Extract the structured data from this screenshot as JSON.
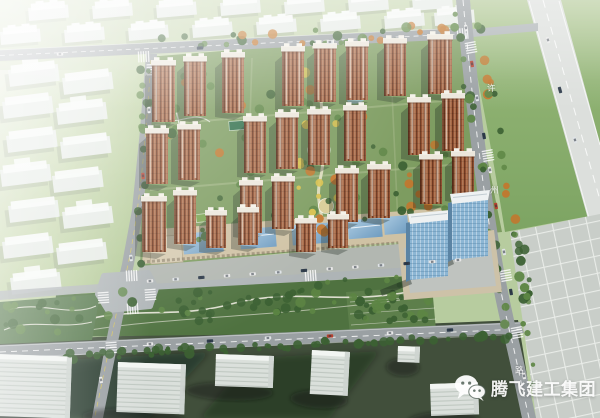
{
  "image": {
    "kind": "aerial-architectural-rendering",
    "description": "Bird's-eye master-plan rendering of a residential community with red-brown high-rise towers, central landscaped axis, south commercial strip with blue glass roofs, two blue office towers, surrounded by roads, faded context buildings and a tiled plaza"
  },
  "watermark": {
    "icon": "wechat-icon",
    "brand_text": "腾飞建工集团"
  },
  "road_labels": {
    "right_road_chars": [
      "许",
      "州",
      "路"
    ]
  },
  "palette": {
    "grass_base": "#b7cc9f",
    "grass_left": "#c8d8b0",
    "grass_right": "#8fb272",
    "site_green": "#7d9c60",
    "park_dark": "#4f7240",
    "ground_dark": "#414f3b",
    "road": "#9aa0a3",
    "road_light": "#aeb4b6",
    "road_wide": "#dcdfdc",
    "plaza": "#c9cec9",
    "ghost": "#e9edea",
    "ghost_top": "#f7f9f7",
    "tower_base": "#a05a38",
    "tower_dark": "#6e3a22",
    "roof": "#ece7dc",
    "td": "#3c6133",
    "tm": "#5d8544",
    "to": "#c4762c",
    "ty": "#d8c04a",
    "water": "#93bac6",
    "glass_roof": "#7fa8c8",
    "office_blue": "#8cb6d4",
    "beige": "#d3c7ab",
    "car_white": "#e8e8e8",
    "car_red": "#b8412f",
    "car_dark": "#2f3d4d",
    "car_silver": "#dfe3e6"
  },
  "scene": {
    "towers": [
      [
        152,
        64,
        23,
        58
      ],
      [
        184,
        60,
        22,
        56
      ],
      [
        222,
        56,
        22,
        57
      ],
      [
        282,
        50,
        22,
        56
      ],
      [
        314,
        47,
        22,
        55
      ],
      [
        346,
        45,
        22,
        55
      ],
      [
        384,
        42,
        22,
        54
      ],
      [
        428,
        38,
        24,
        56
      ],
      [
        146,
        132,
        22,
        52
      ],
      [
        178,
        128,
        22,
        52
      ],
      [
        244,
        120,
        22,
        53
      ],
      [
        276,
        116,
        22,
        53
      ],
      [
        308,
        113,
        22,
        52
      ],
      [
        344,
        109,
        22,
        52
      ],
      [
        408,
        101,
        22,
        54
      ],
      [
        442,
        97,
        22,
        54
      ],
      [
        142,
        200,
        24,
        52
      ],
      [
        174,
        194,
        22,
        50
      ],
      [
        240,
        184,
        22,
        49
      ],
      [
        272,
        180,
        22,
        49
      ],
      [
        336,
        172,
        22,
        50
      ],
      [
        368,
        168,
        22,
        50
      ],
      [
        420,
        158,
        22,
        46
      ],
      [
        452,
        155,
        22,
        42
      ],
      [
        206,
        214,
        20,
        34
      ],
      [
        238,
        211,
        20,
        34
      ],
      [
        296,
        222,
        20,
        30
      ],
      [
        328,
        218,
        20,
        30
      ]
    ],
    "ghost_buildings": [
      [
        28,
        8
      ],
      [
        92,
        6
      ],
      [
        156,
        5
      ],
      [
        220,
        3
      ],
      [
        284,
        2
      ],
      [
        348,
        0
      ],
      [
        412,
        -2
      ],
      [
        0,
        32
      ],
      [
        64,
        30
      ],
      [
        128,
        28
      ],
      [
        192,
        25
      ],
      [
        256,
        22
      ],
      [
        320,
        19
      ],
      [
        384,
        16
      ],
      [
        434,
        13
      ]
    ],
    "slabs": [
      [
        8,
        70
      ],
      [
        62,
        78
      ],
      [
        2,
        102
      ],
      [
        56,
        108
      ],
      [
        6,
        136
      ],
      [
        60,
        142
      ],
      [
        0,
        170
      ],
      [
        52,
        176
      ],
      [
        8,
        206
      ],
      [
        62,
        212
      ],
      [
        2,
        242
      ],
      [
        56,
        248
      ],
      [
        10,
        278
      ]
    ],
    "bottom_buildings": [
      [
        -4,
        354,
        76,
        62,
        2
      ],
      [
        118,
        362,
        68,
        50,
        2
      ],
      [
        216,
        354,
        58,
        32,
        2
      ],
      [
        312,
        350,
        38,
        44,
        3
      ],
      [
        398,
        346,
        22,
        16,
        2
      ],
      [
        430,
        384,
        48,
        32,
        -2
      ]
    ],
    "tree_regions": [
      [
        150,
        38,
        312,
        16,
        30,
        [
          "td",
          "tm",
          "to"
        ],
        0,
        -0.05
      ],
      [
        138,
        60,
        14,
        205,
        20,
        [
          "td",
          "tm"
        ],
        0,
        0
      ],
      [
        158,
        62,
        300,
        180,
        64,
        [
          "td",
          "tm",
          "to",
          "tm"
        ],
        0,
        -0.04
      ],
      [
        298,
        56,
        44,
        186,
        18,
        [
          "ty",
          "to",
          "ty"
        ],
        0,
        0
      ],
      [
        58,
        294,
        372,
        34,
        56,
        [
          "td",
          "tm",
          "td"
        ],
        0,
        -0.05
      ],
      [
        66,
        352,
        450,
        8,
        34,
        [
          "td"
        ],
        0,
        -0.045
      ],
      [
        448,
        8,
        8,
        330,
        22,
        [
          "td",
          "tm"
        ],
        0.165,
        0
      ],
      [
        472,
        8,
        8,
        300,
        22,
        [
          "td",
          "to",
          "tm"
        ],
        0.165,
        0
      ],
      [
        348,
        296,
        82,
        30,
        26,
        [
          "tm",
          "td"
        ],
        0,
        -0.04
      ],
      [
        158,
        70,
        58,
        92,
        16,
        [
          "tm",
          "to",
          "td"
        ],
        0,
        0
      ],
      [
        506,
        240,
        10,
        170,
        10,
        [
          "td",
          "tm"
        ],
        0.05,
        0
      ],
      [
        4,
        300,
        92,
        32,
        14,
        [
          "td",
          "tm"
        ],
        0,
        0
      ],
      [
        400,
        180,
        60,
        40,
        10,
        [
          "td",
          "to"
        ],
        0,
        0
      ]
    ],
    "cars": [
      [
        466,
        28,
        80,
        "car_white"
      ],
      [
        472,
        64,
        80,
        "car_red"
      ],
      [
        477,
        98,
        80,
        "car_silver"
      ],
      [
        484,
        136,
        80,
        "car_dark"
      ],
      [
        490,
        170,
        80,
        "car_white"
      ],
      [
        496,
        206,
        80,
        "car_red"
      ],
      [
        504,
        252,
        80,
        "car_silver"
      ],
      [
        511,
        292,
        80,
        "car_dark"
      ],
      [
        524,
        376,
        80,
        "car_white"
      ],
      [
        150,
        344,
        -3,
        "car_white"
      ],
      [
        210,
        341,
        -3,
        "car_dark"
      ],
      [
        268,
        338,
        -3,
        "car_silver"
      ],
      [
        330,
        336,
        -3,
        "car_red"
      ],
      [
        390,
        333,
        -3,
        "car_white"
      ],
      [
        450,
        330,
        -3,
        "car_dark"
      ],
      [
        149,
        110,
        86,
        "car_white"
      ],
      [
        143,
        176,
        86,
        "car_red"
      ],
      [
        131,
        258,
        84,
        "car_silver"
      ],
      [
        101,
        380,
        82,
        "car_white"
      ],
      [
        60,
        54,
        -2,
        "car_white"
      ],
      [
        200,
        48,
        -3,
        "car_dark"
      ],
      [
        330,
        42,
        -3,
        "car_silver"
      ],
      [
        548,
        40,
        74,
        "car_white"
      ],
      [
        560,
        90,
        74,
        "car_dark"
      ],
      [
        575,
        140,
        74,
        "car_silver"
      ]
    ],
    "parked_row": {
      "x0": 150,
      "y0": 281,
      "x1": 458,
      "y1": 260,
      "n": 13,
      "colors": [
        "car_white",
        "car_silver",
        "car_dark",
        "car_white"
      ]
    },
    "crosswalks": [
      [
        138,
        57,
        -3
      ],
      [
        152,
        64,
        88
      ],
      [
        457,
        34,
        -4
      ],
      [
        470,
        42,
        80
      ],
      [
        487,
        150,
        80
      ],
      [
        505,
        270,
        80
      ],
      [
        305,
        276,
        -4
      ],
      [
        126,
        276,
        -3
      ],
      [
        103,
        292,
        86
      ],
      [
        150,
        289,
        86
      ],
      [
        127,
        309,
        -4
      ],
      [
        111,
        342,
        86
      ],
      [
        516,
        327,
        80
      ]
    ]
  }
}
